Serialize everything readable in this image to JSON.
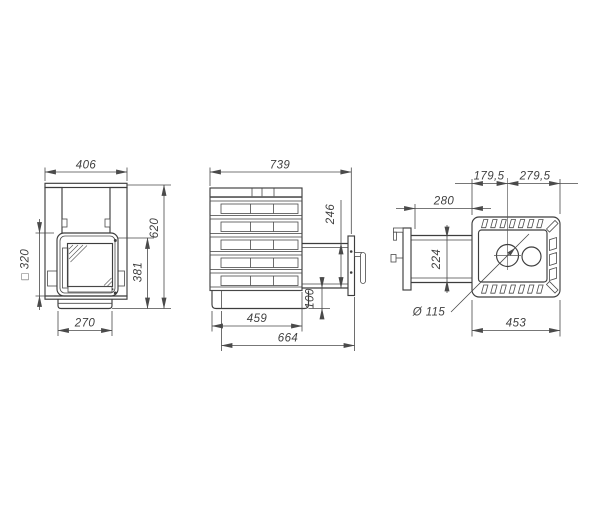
{
  "drawing": {
    "background": "#ffffff",
    "ink": "#3a3a3a",
    "type": "stove-three-view-technical-drawing"
  },
  "dims": {
    "front": {
      "overall_width": "406",
      "door_square": "□ 320",
      "base_width": "270",
      "door_top_height": "381",
      "overall_height": "620"
    },
    "side": {
      "overall_depth": "739",
      "tunnel_height": "246",
      "plinth_height": "100",
      "body_depth": "459",
      "depth_with_tunnel": "664"
    },
    "top": {
      "chimney_offset_left": "179,5",
      "chimney_offset_right": "279,5",
      "tunnel_protrusion": "280",
      "tunnel_width": "224",
      "chimney_diameter": "Ø 115",
      "body_width": "453"
    }
  }
}
